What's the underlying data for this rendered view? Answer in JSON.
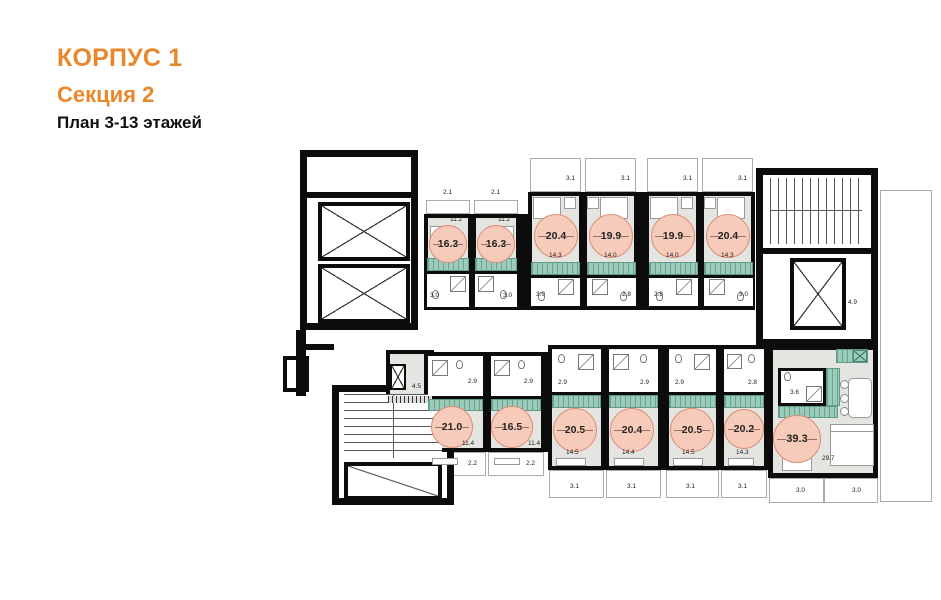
{
  "title": {
    "building": "КОРПУС 1",
    "section": "Секция 2",
    "plan": "План 3-13 этажей"
  },
  "colors": {
    "accent_orange": "#E8872B",
    "area_circle_fill": "#F7CBBA",
    "area_circle_border": "#D98C76",
    "kitchen_teal": "#9DCBBA",
    "floor_gray": "#E4E4E1",
    "wall_black": "#0C0C0C"
  },
  "top_units": [
    {
      "area": "16.3",
      "room": "11.2",
      "bath": "3.0",
      "balcony": "2.1"
    },
    {
      "area": "16.3",
      "room": "11.2",
      "bath": "3.0",
      "balcony": "2.1"
    },
    {
      "area": "20.4",
      "room": "14.3",
      "bath": "3.0",
      "balcony": "3.1"
    },
    {
      "area": "19.9",
      "room": "14.0",
      "bath": "2.8",
      "balcony": "3.1"
    },
    {
      "area": "19.9",
      "room": "14.0",
      "bath": "2.8",
      "balcony": "3.1"
    },
    {
      "area": "20.4",
      "room": "14.3",
      "bath": "3.0",
      "balcony": "3.1"
    }
  ],
  "bottom_units": [
    {
      "area": "21.0",
      "room": "11.4",
      "bath": "2.9",
      "balcony": "2.2"
    },
    {
      "area": "16.5",
      "room": "11.4",
      "bath": "2.9",
      "balcony": "2.2"
    },
    {
      "area": "20.5",
      "room": "14.5",
      "bath": "2.9",
      "balcony": "3.1"
    },
    {
      "area": "20.4",
      "room": "14.4",
      "bath": "2.9",
      "balcony": "3.1"
    },
    {
      "area": "20.5",
      "room": "14.5",
      "bath": "2.9",
      "balcony": "3.1"
    },
    {
      "area": "20.2",
      "room": "14.3",
      "bath": "2.8",
      "balcony": "3.1"
    }
  ],
  "large_unit": {
    "area": "39.3",
    "bath": "3.6",
    "living": "29.7",
    "balcony_left": "3.0",
    "balcony_right": "3.0"
  },
  "service": {
    "utility": "4.5",
    "lobby": "4.9"
  }
}
